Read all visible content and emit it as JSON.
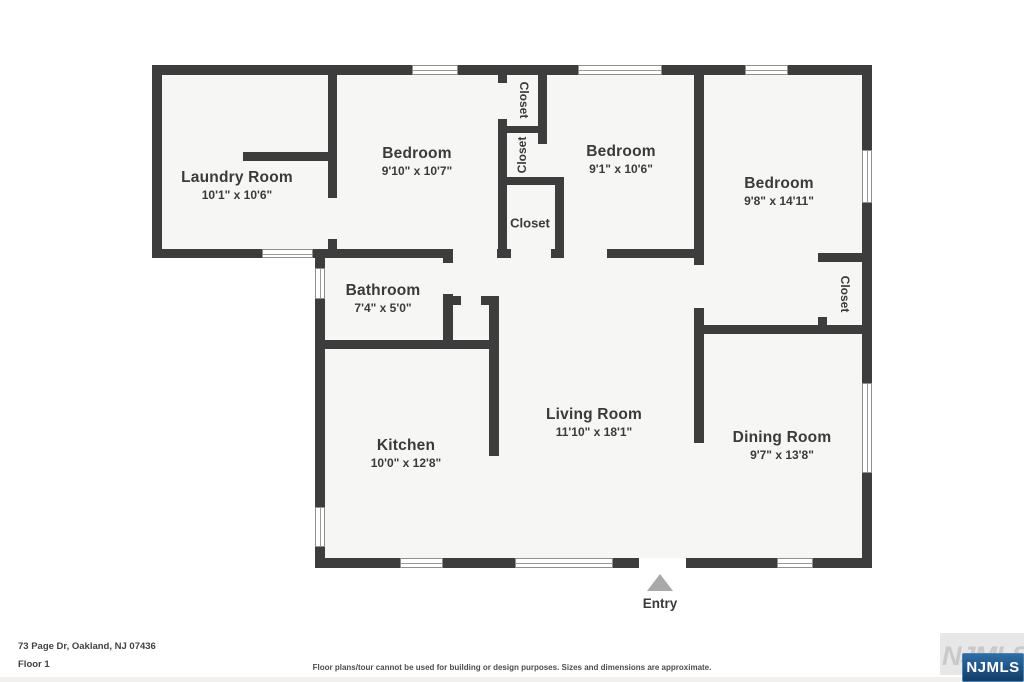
{
  "floorplan": {
    "rooms": [
      {
        "name": "Laundry Room",
        "dims": "10'1\" x 10'6\""
      },
      {
        "name": "Bedroom",
        "dims": "9'10\" x 10'7\""
      },
      {
        "name": "Bedroom",
        "dims": "9'1\" x 10'6\""
      },
      {
        "name": "Bedroom",
        "dims": "9'8\" x 14'11\""
      },
      {
        "name": "Bathroom",
        "dims": "7'4\" x 5'0\""
      },
      {
        "name": "Kitchen",
        "dims": "10'0\" x 12'8\""
      },
      {
        "name": "Living Room",
        "dims": "11'10\" x 18'1\""
      },
      {
        "name": "Dining Room",
        "dims": "9'7\" x 13'8\""
      }
    ],
    "closets": {
      "top": "Closet",
      "middle": "Closet",
      "hall": "Closet",
      "bedroom3": "Closet"
    },
    "entry_label": "Entry"
  },
  "footer": {
    "address": "73 Page Dr, Oakland, NJ 07436",
    "floor": "Floor 1",
    "disclaimer": "Floor plans/tour cannot be used for building or design purposes. Sizes and dimensions are approximate."
  },
  "branding": {
    "mls": "NJMLS",
    "watermark": "NJMLS"
  },
  "colors": {
    "wall": "#3d3d3d",
    "floor": "#f6f6f5",
    "entry_arrow": "#a9a9a9",
    "badge_navy": "#1b4c7d"
  }
}
